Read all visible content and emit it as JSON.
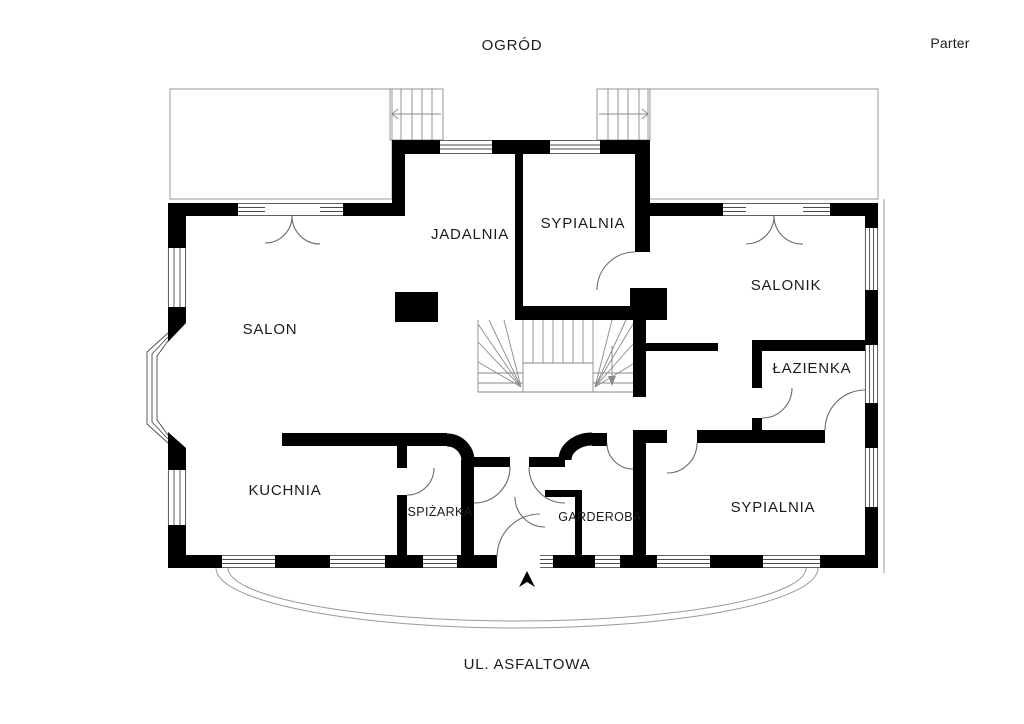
{
  "plan": {
    "floor_title": "Parter",
    "garden_label": "OGRÓD",
    "street_label": "UL. ASFALTOWA",
    "rooms": {
      "jadalnia": "JADALNIA",
      "sypialnia_top": "SYPIALNIA",
      "salonik": "SALONIK",
      "salon": "SALON",
      "lazienka": "ŁAZIENKA",
      "kuchnia": "KUCHNIA",
      "spizarka": "SPIŻARKA",
      "garderoba": "GARDEROBA",
      "sypialnia_bottom": "SYPIALNIA"
    },
    "colors": {
      "wall": "#000000",
      "background": "#ffffff",
      "door_arc": "#6a6a6a",
      "terrace_line": "#9a9a9a"
    },
    "compass": "north-up"
  }
}
